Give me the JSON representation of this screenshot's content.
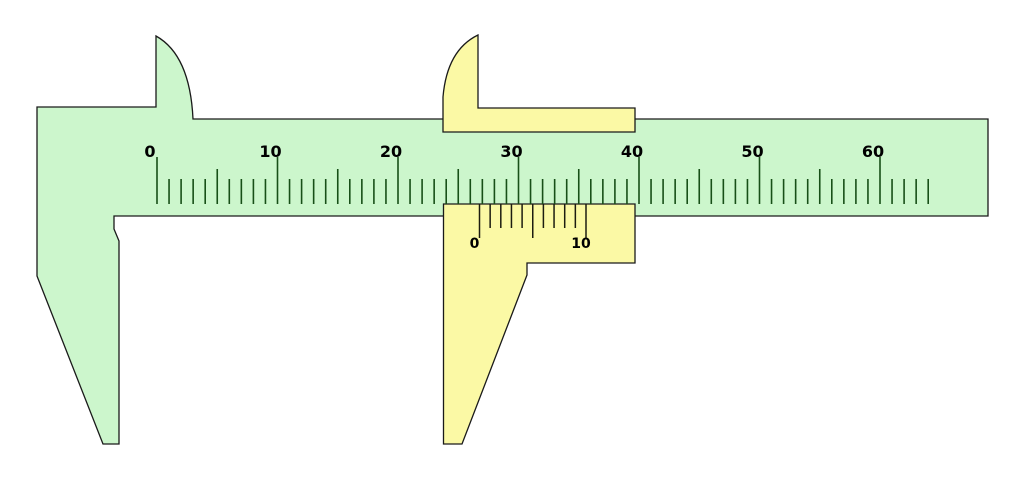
{
  "diagram": {
    "kind": "vernier-caliper",
    "background": "#ffffff",
    "colors": {
      "body_green": "#ccf6cc",
      "slider_yellow": "#fbf9a5",
      "outline": "#1a1a1a",
      "main_tick": "#174f17",
      "vernier_tick": "#1c1c10",
      "label_text": "#000000"
    },
    "main_scale": {
      "labels": [
        "0",
        "10",
        "20",
        "30",
        "40",
        "50",
        "60"
      ],
      "label_values": [
        0,
        10,
        20,
        30,
        40,
        50,
        60
      ],
      "tick_count": 65,
      "start_x": 157,
      "px_per_unit": 12.05,
      "tick_bottom_y": 204,
      "tick_top_unit": 179,
      "tick_top_five": 169,
      "tick_top_ten": 157,
      "tick_width": 1.6,
      "label_baseline_y": 157,
      "label_dx": -7
    },
    "vernier_scale": {
      "labels": [
        "0",
        "10"
      ],
      "label_values": [
        0,
        10
      ],
      "tick_count": 11,
      "start_x": 479.5,
      "px_per_unit": 10.65,
      "tick_top_y": 204,
      "tick_bottom_long": 238,
      "tick_bottom_short": 228,
      "tick_width": 1.5,
      "label_baseline_y": 248,
      "label_dx": -5
    }
  }
}
